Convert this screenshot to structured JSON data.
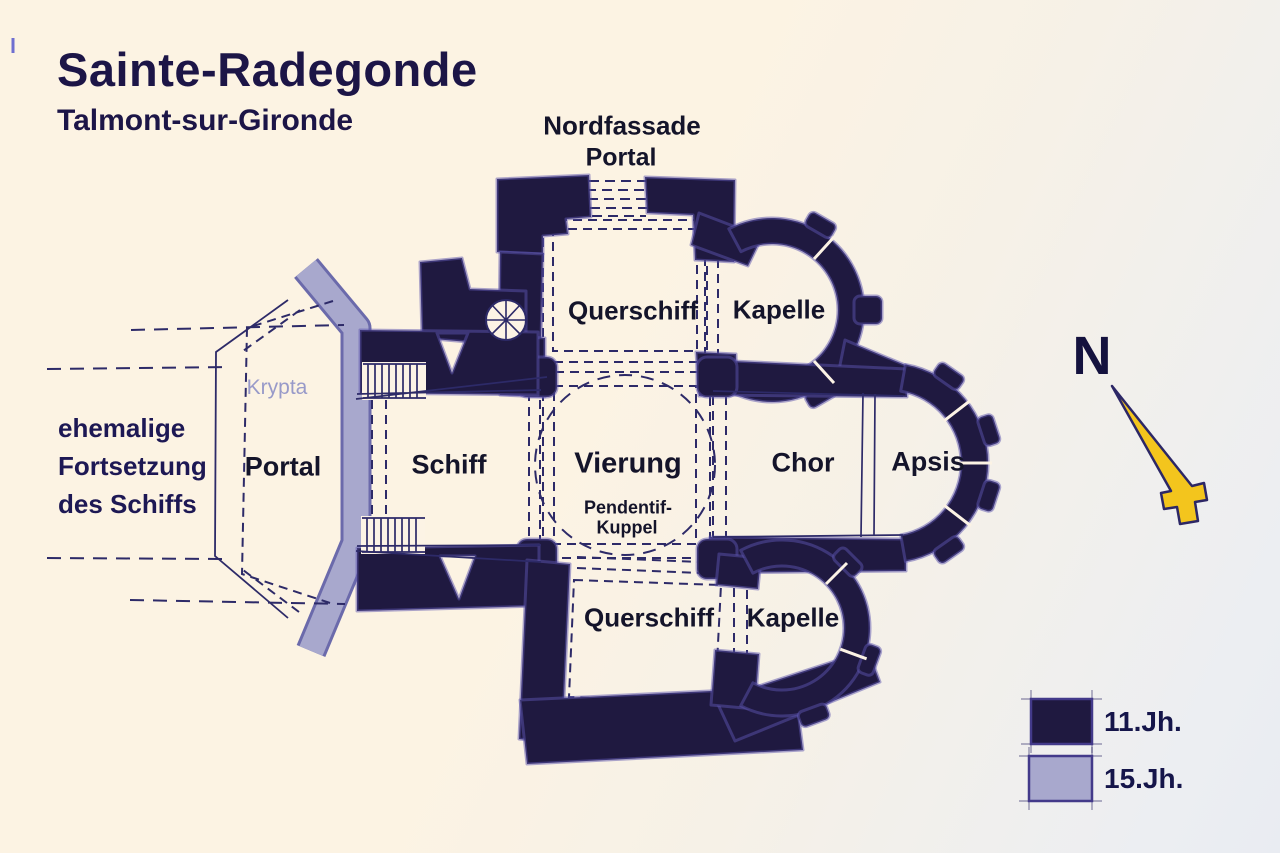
{
  "header": {
    "title": "Sainte-Radegonde",
    "subtitle": "Talmont-sur-Gironde"
  },
  "plan_labels": {
    "nordfassade": "Nordfassade",
    "nordfassade_portal": "Portal",
    "querschiff_nord": "Querschiff",
    "kapelle_nord": "Kapelle",
    "vierung": "Vierung",
    "pendentif_line1": "Pendentif-",
    "pendentif_line2": "Kuppel",
    "chor": "Chor",
    "apsis": "Apsis",
    "schiff": "Schiff",
    "portal_west": "Portal",
    "krypta": "Krypta",
    "querschiff_sued": "Querschiff",
    "kapelle_sued": "Kapelle"
  },
  "annotation": {
    "line1": "ehemalige",
    "line2": "Fortsetzung",
    "line3": "des Schiffs"
  },
  "compass": {
    "label": "N",
    "arrow_color": "#f3c51d"
  },
  "legend": {
    "items": [
      {
        "label": "11.Jh.",
        "color": "#1f1940"
      },
      {
        "label": "15.Jh.",
        "color": "#a8a8cd"
      }
    ]
  },
  "colors": {
    "wall_11jh": "#1f1940",
    "wall_15jh": "#a8a8cd",
    "ink": "#2d2a68",
    "paper": "#fcf3e5",
    "title_text": "#1c1547",
    "krypta_text": "#989ac9"
  }
}
